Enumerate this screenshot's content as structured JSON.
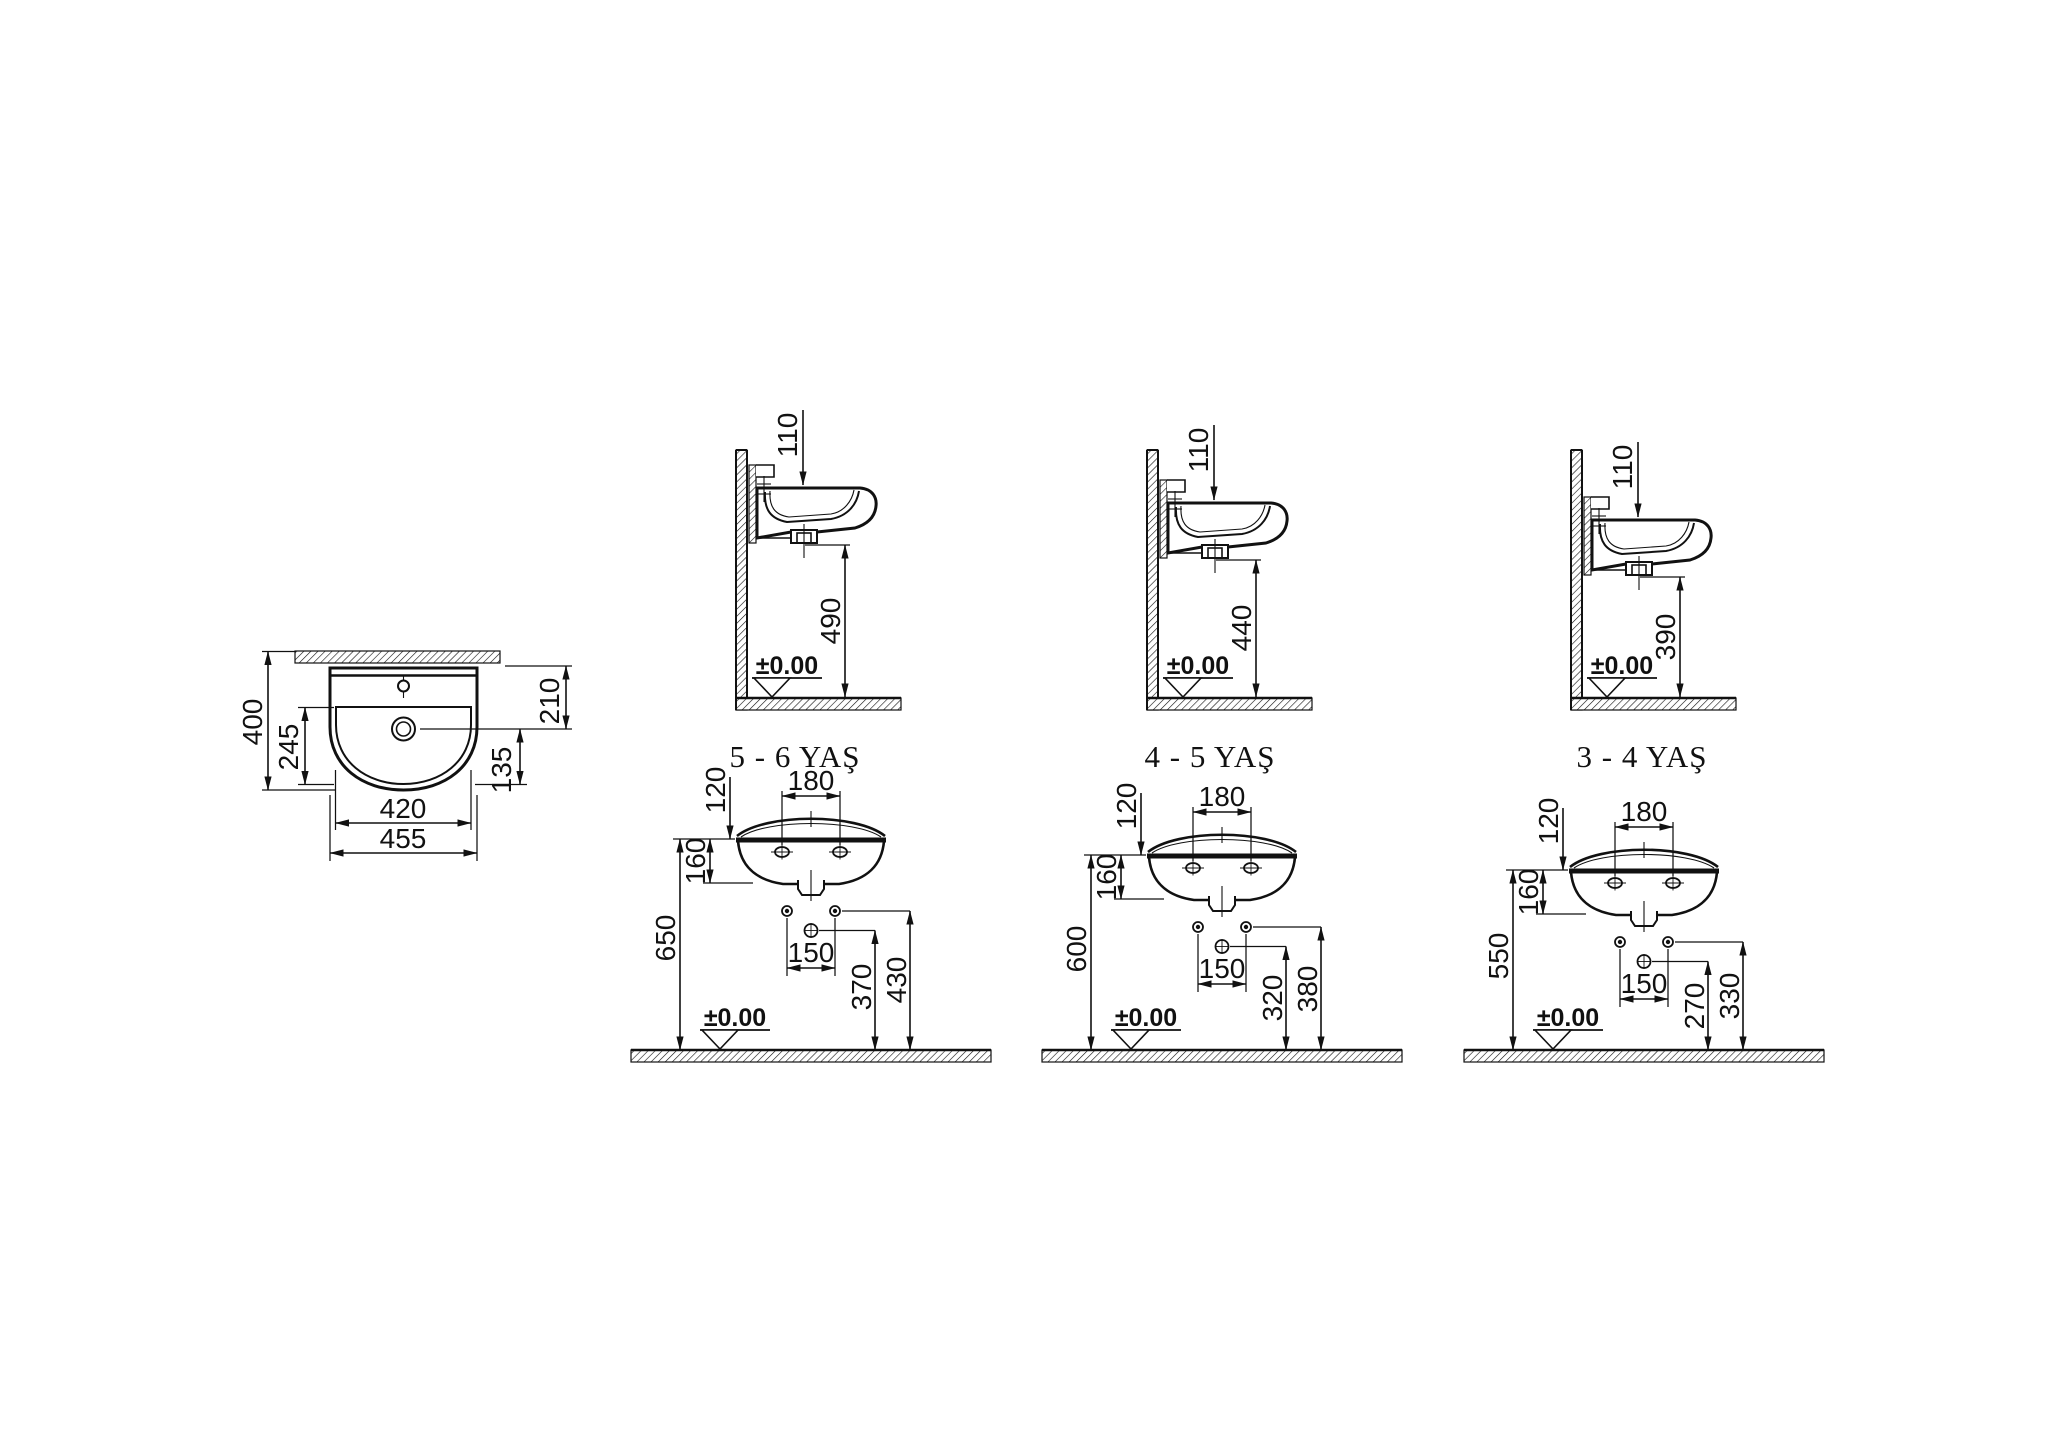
{
  "drawing": {
    "datum_label": "±0.00",
    "colors": {
      "line": "#111111",
      "background": "#ffffff"
    },
    "plan_view": {
      "overall_depth": "400",
      "bowl_depth": "245",
      "back_to_drain": "210",
      "drain_to_bowl_front": "135",
      "bowl_width": "420",
      "overall_width": "455"
    },
    "side_views": [
      {
        "age_label": "5 - 6 YAŞ",
        "tap_hole_offset": "110",
        "mount_height": "490"
      },
      {
        "age_label": "4 - 5 YAŞ",
        "tap_hole_offset": "110",
        "mount_height": "440"
      },
      {
        "age_label": "3 - 4 YAŞ",
        "tap_hole_offset": "110",
        "mount_height": "390"
      }
    ],
    "front_views": [
      {
        "splash_height": "120",
        "tap_hole_spacing": "180",
        "body_height": "160",
        "rim_height": "650",
        "supply_spacing": "150",
        "drain_supply_height": "370",
        "water_supply_height": "430"
      },
      {
        "splash_height": "120",
        "tap_hole_spacing": "180",
        "body_height": "160",
        "rim_height": "600",
        "supply_spacing": "150",
        "drain_supply_height": "320",
        "water_supply_height": "380"
      },
      {
        "splash_height": "120",
        "tap_hole_spacing": "180",
        "body_height": "160",
        "rim_height": "550",
        "supply_spacing": "150",
        "drain_supply_height": "270",
        "water_supply_height": "330"
      }
    ]
  }
}
